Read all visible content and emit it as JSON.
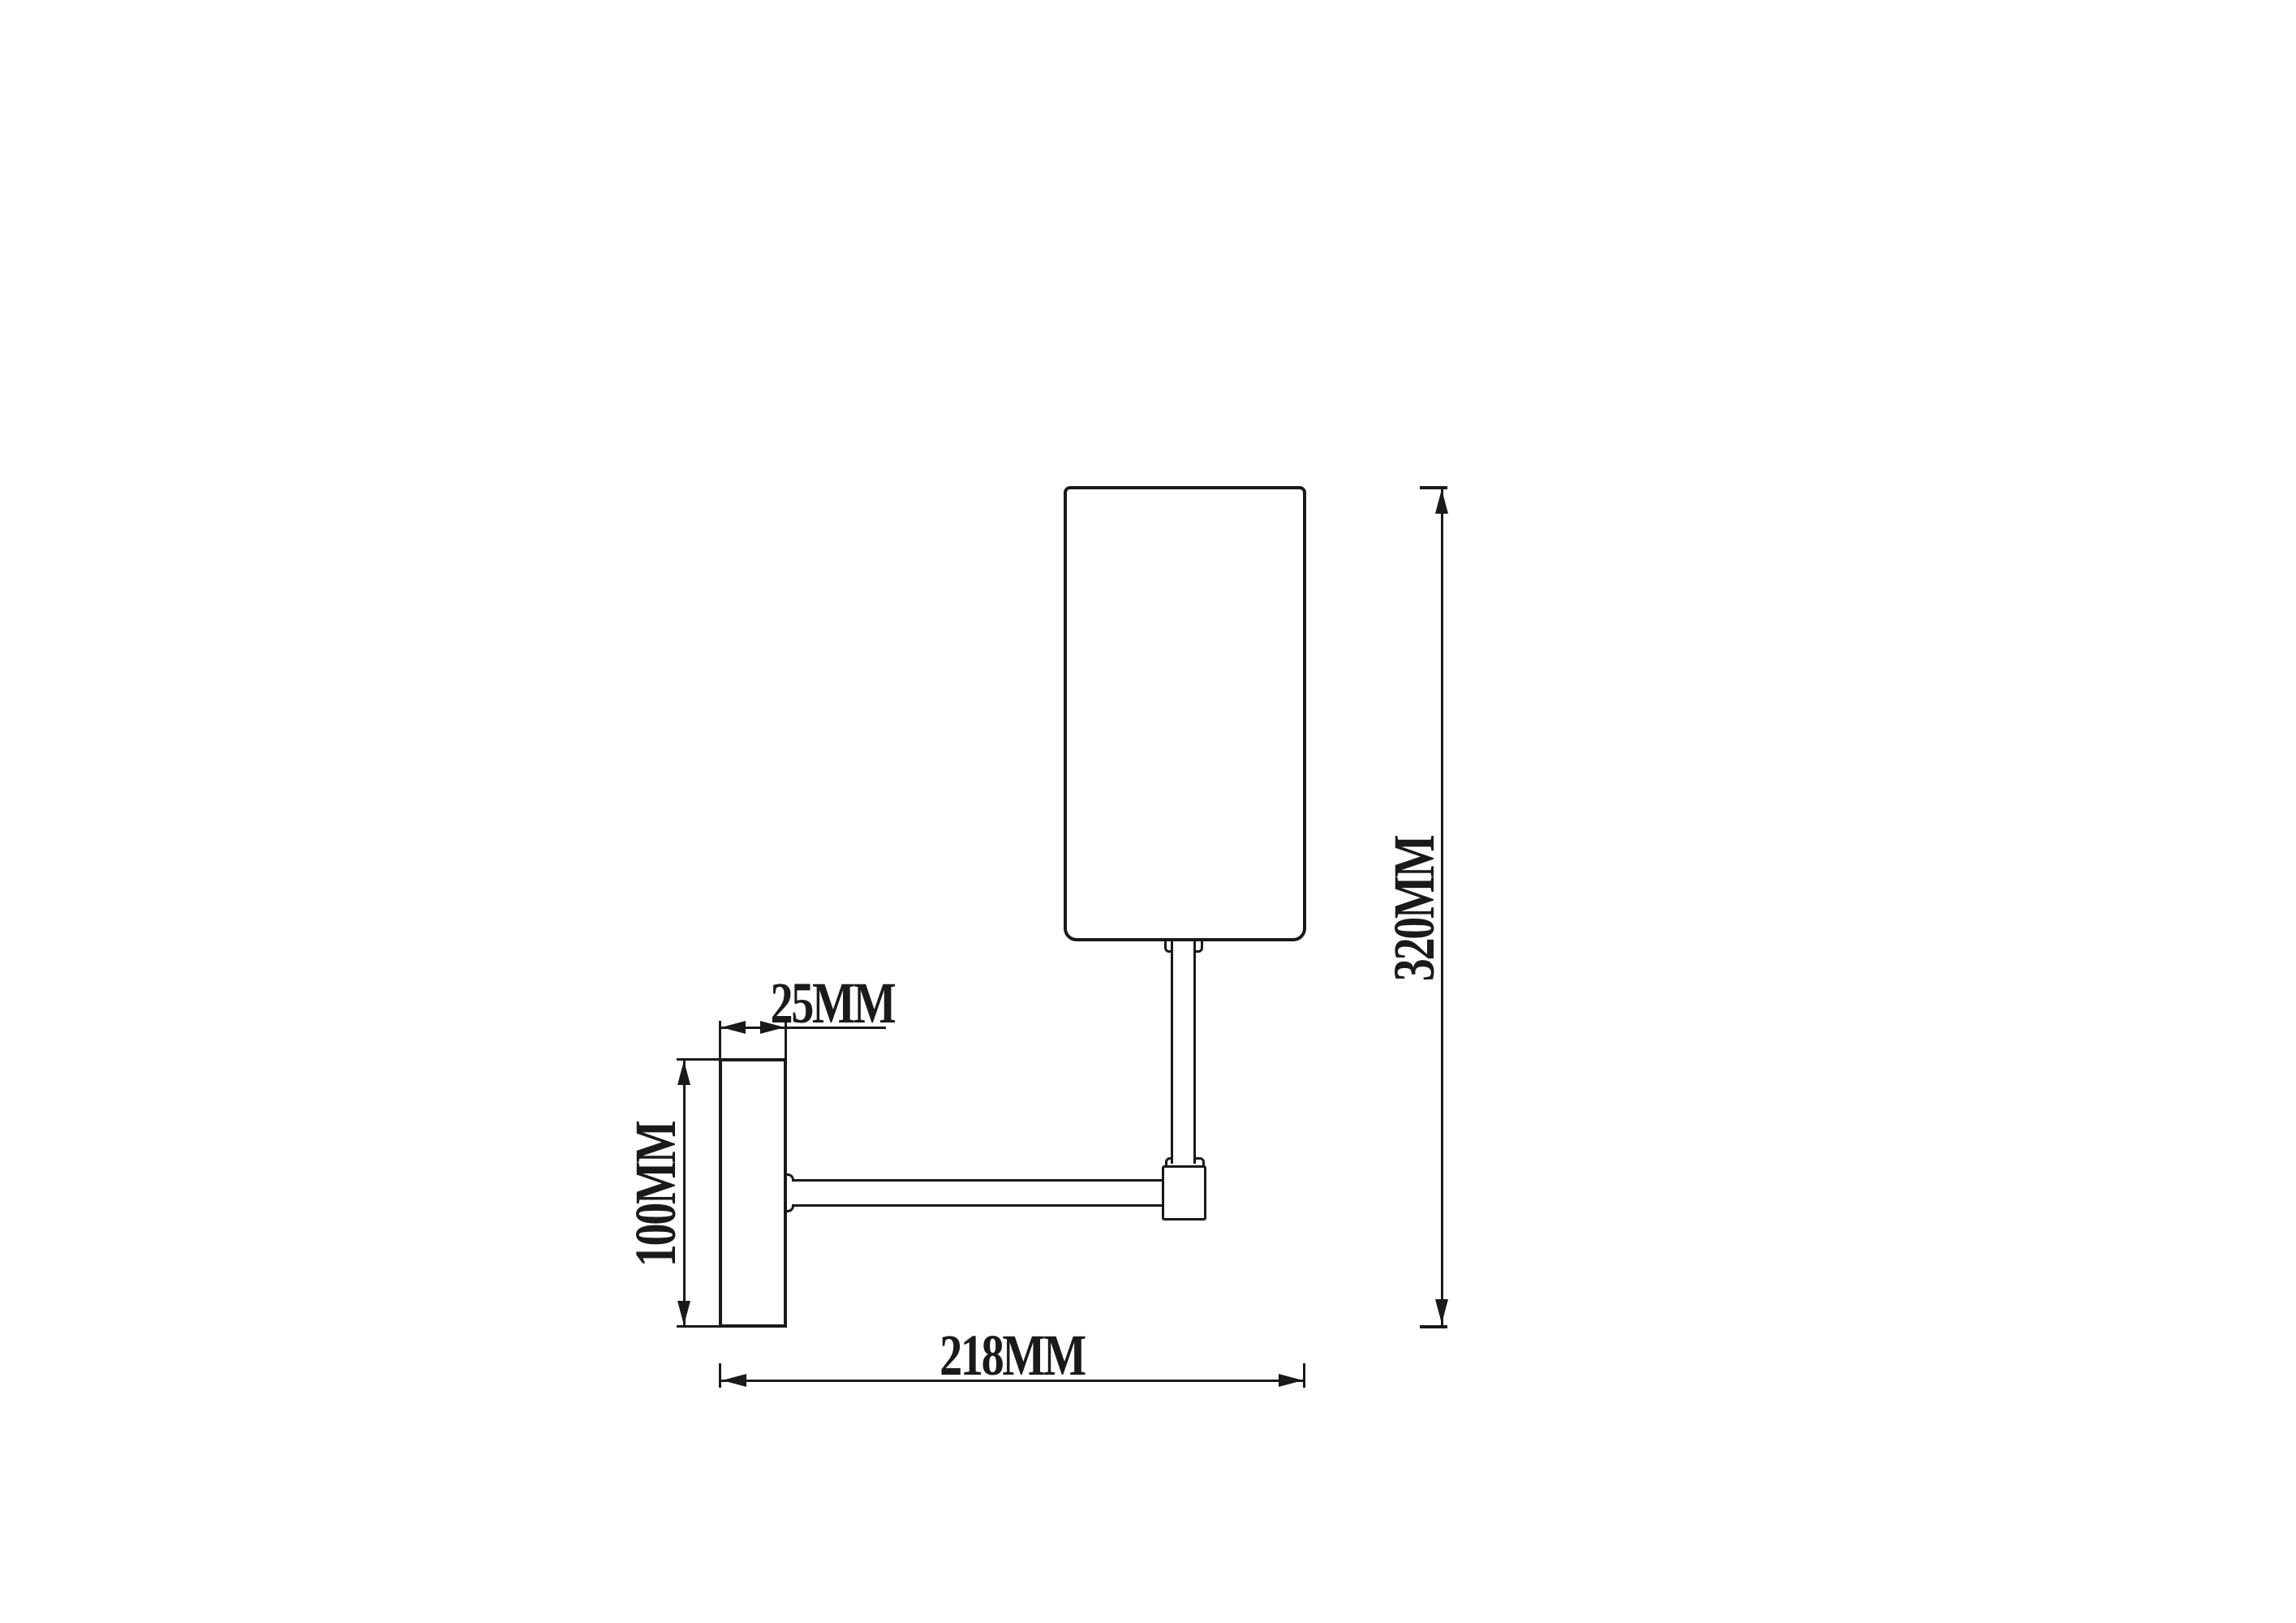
{
  "drawing": {
    "dimension_labels": {
      "bracket_depth": "25MM",
      "backplate_height": "100MM",
      "overall_width": "218MM",
      "overall_height": "320MM"
    },
    "line_color": "#1a1a1a",
    "background_color": "#ffffff"
  }
}
